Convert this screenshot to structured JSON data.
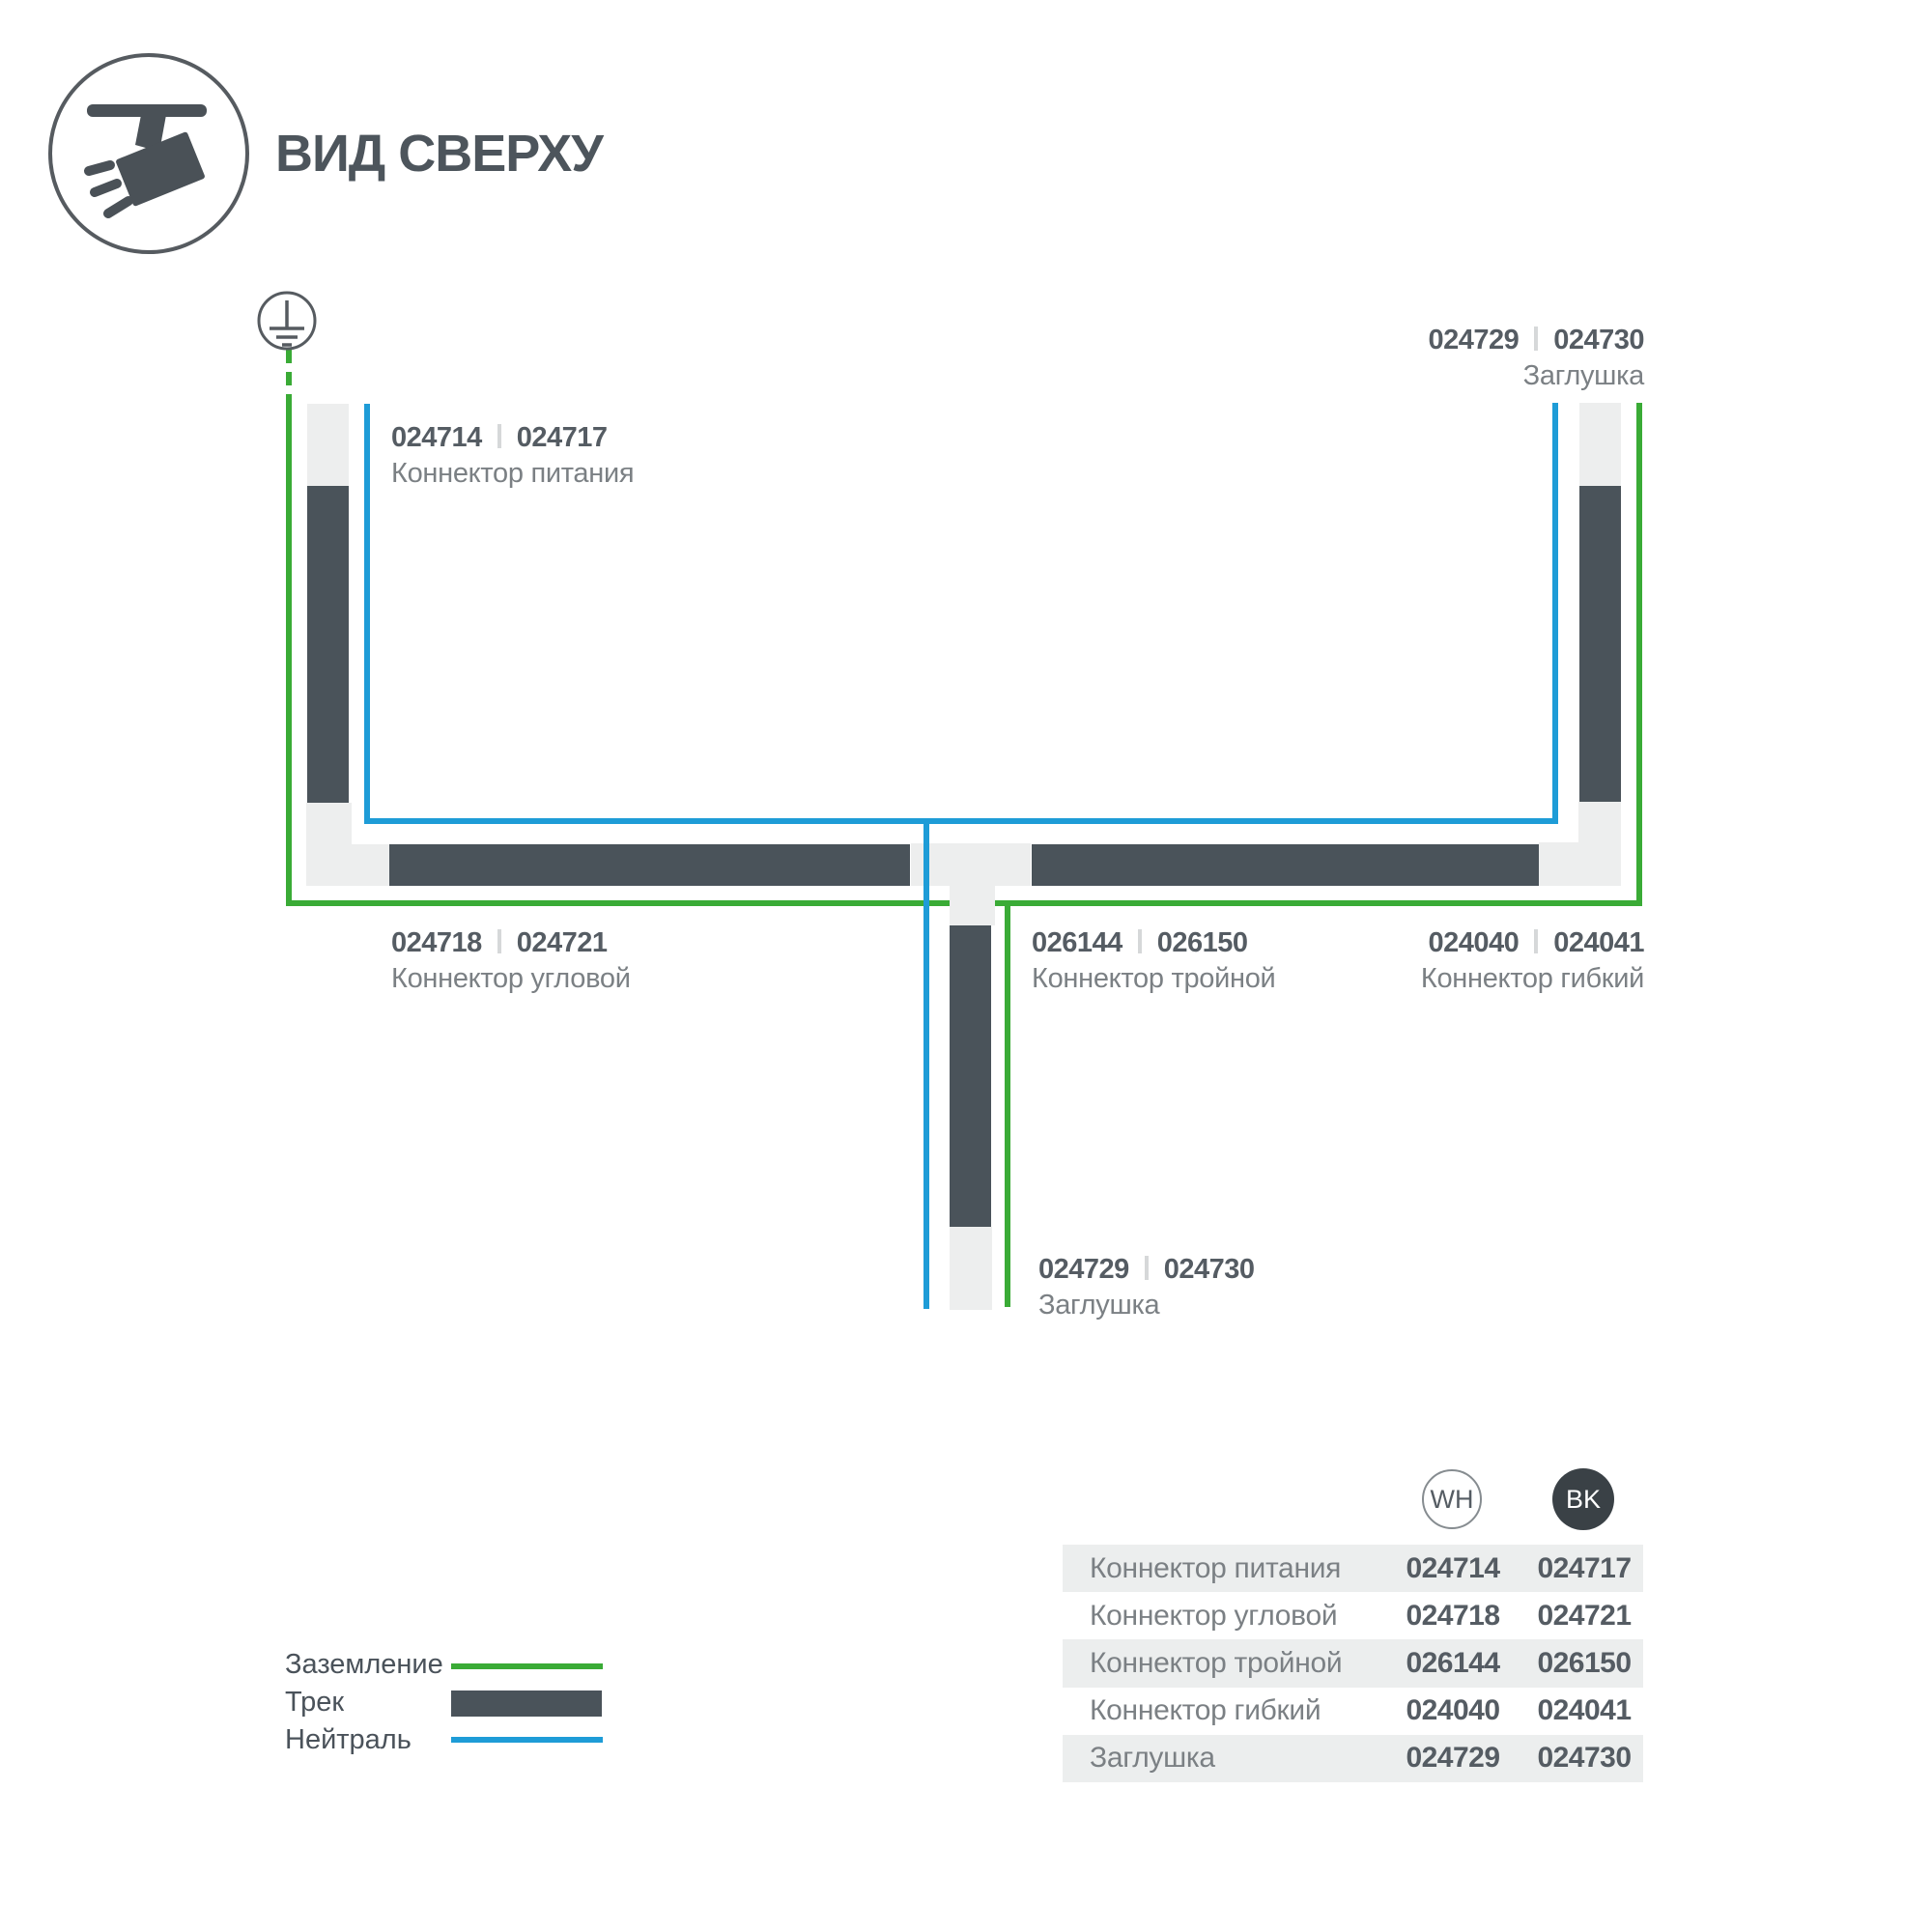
{
  "header": {
    "title": "ВИД СВЕРХУ"
  },
  "diagram": {
    "labels": {
      "power": {
        "wh": "024714",
        "bk": "024717",
        "name": "Коннектор питания"
      },
      "endcap_top": {
        "wh": "024729",
        "bk": "024730",
        "name": "Заглушка"
      },
      "corner": {
        "wh": "024718",
        "bk": "024721",
        "name": "Коннектор угловой"
      },
      "triple": {
        "wh": "026144",
        "bk": "026150",
        "name": "Коннектор тройной"
      },
      "flexible": {
        "wh": "024040",
        "bk": "024041",
        "name": "Коннектор гибкий"
      },
      "endcap_bottom": {
        "wh": "024729",
        "bk": "024730",
        "name": "Заглушка"
      }
    },
    "colors": {
      "ground_green": "#3aab36",
      "neutral_blue": "#1e9cd7",
      "track_dark": "#4a535a",
      "connector_light": "#edeeee"
    }
  },
  "legend": {
    "items": [
      {
        "label": "Заземление"
      },
      {
        "label": "Трек"
      },
      {
        "label": "Нейтраль"
      }
    ]
  },
  "table": {
    "columns": [
      {
        "code": "WH"
      },
      {
        "code": "BK"
      }
    ],
    "rows": [
      {
        "name": "Коннектор питания",
        "wh": "024714",
        "bk": "024717"
      },
      {
        "name": "Коннектор угловой",
        "wh": "024718",
        "bk": "024721"
      },
      {
        "name": "Коннектор тройной",
        "wh": "026144",
        "bk": "026150"
      },
      {
        "name": "Коннектор гибкий",
        "wh": "024040",
        "bk": "024041"
      },
      {
        "name": "Заглушка",
        "wh": "024729",
        "bk": "024730"
      }
    ]
  }
}
